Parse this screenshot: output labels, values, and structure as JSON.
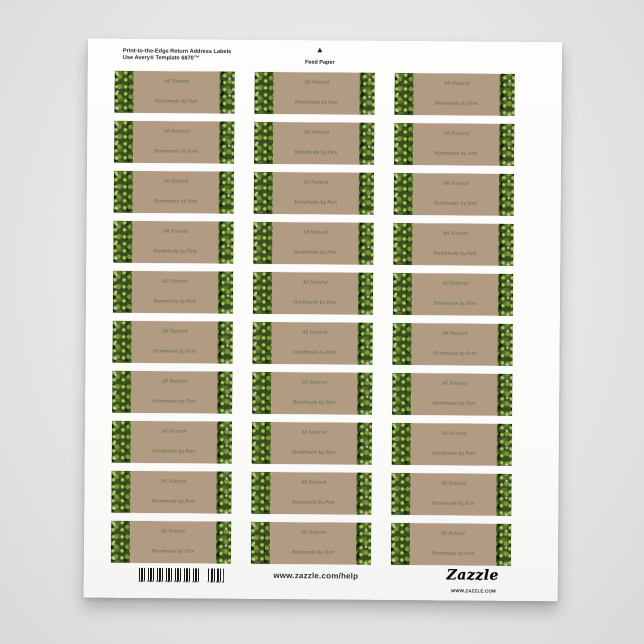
{
  "page": {
    "background_color": "#e6e6e6",
    "description": "Product photo of a printable return address label sheet"
  },
  "sheet": {
    "paper_color": "#fbfbfa",
    "header": {
      "line1": "Print-to-the-Edge Return Address Labels",
      "line2": "Use Avery® Template 6870™"
    },
    "feed_marker": {
      "arrow": "▲",
      "label": "Feed Paper"
    },
    "labels": {
      "count": 30,
      "columns": 3,
      "rows": 10,
      "line1": "All Natural",
      "line2": "Handmade by Pam",
      "text_color": "#44633a",
      "center_color": "#b29b83",
      "edge_motif": "green-foliage-photo-strip"
    },
    "footer": {
      "barcode": "barcode",
      "help_url": "www.zazzle.com/help",
      "brand": "Zazzle",
      "brand_sub": "WWW.ZAZZLE.COM"
    }
  }
}
